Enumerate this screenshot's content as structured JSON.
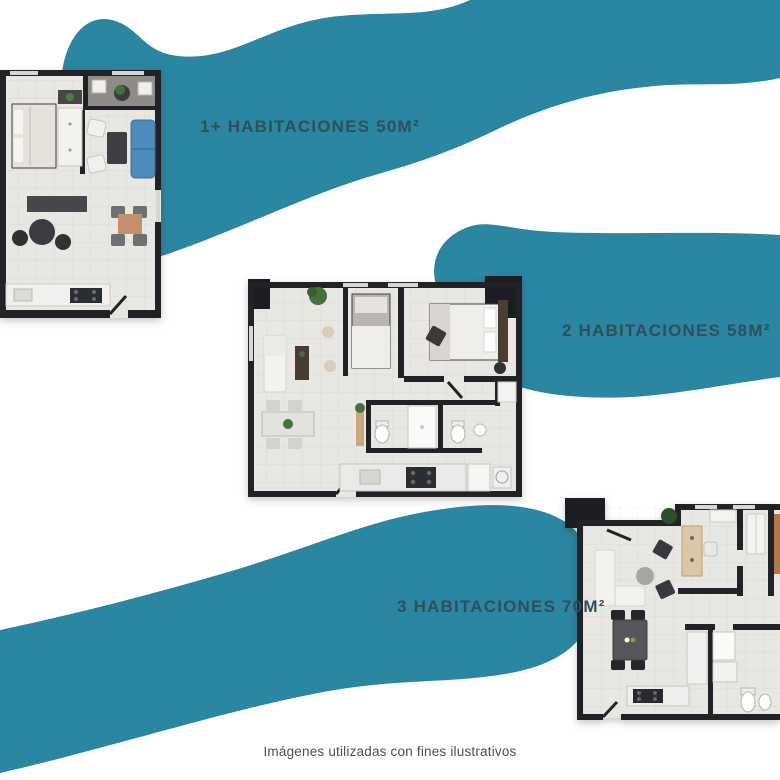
{
  "colors": {
    "background": "#FFFFFF",
    "ribbon_teal": "#2B86A1",
    "label_text": "#2C4F58",
    "footer_text": "#4E4E4E",
    "wall_dark": "#232327",
    "sofa_blue": "#4E8CBA"
  },
  "ribbons": [
    {
      "label": "1+ HABITACIONES 50M²"
    },
    {
      "label": "2 HABITACIONES 58M²"
    },
    {
      "label": "3 HABITACIONES 70M²"
    }
  ],
  "footer": "Imágenes utilizadas con fines ilustrativos"
}
